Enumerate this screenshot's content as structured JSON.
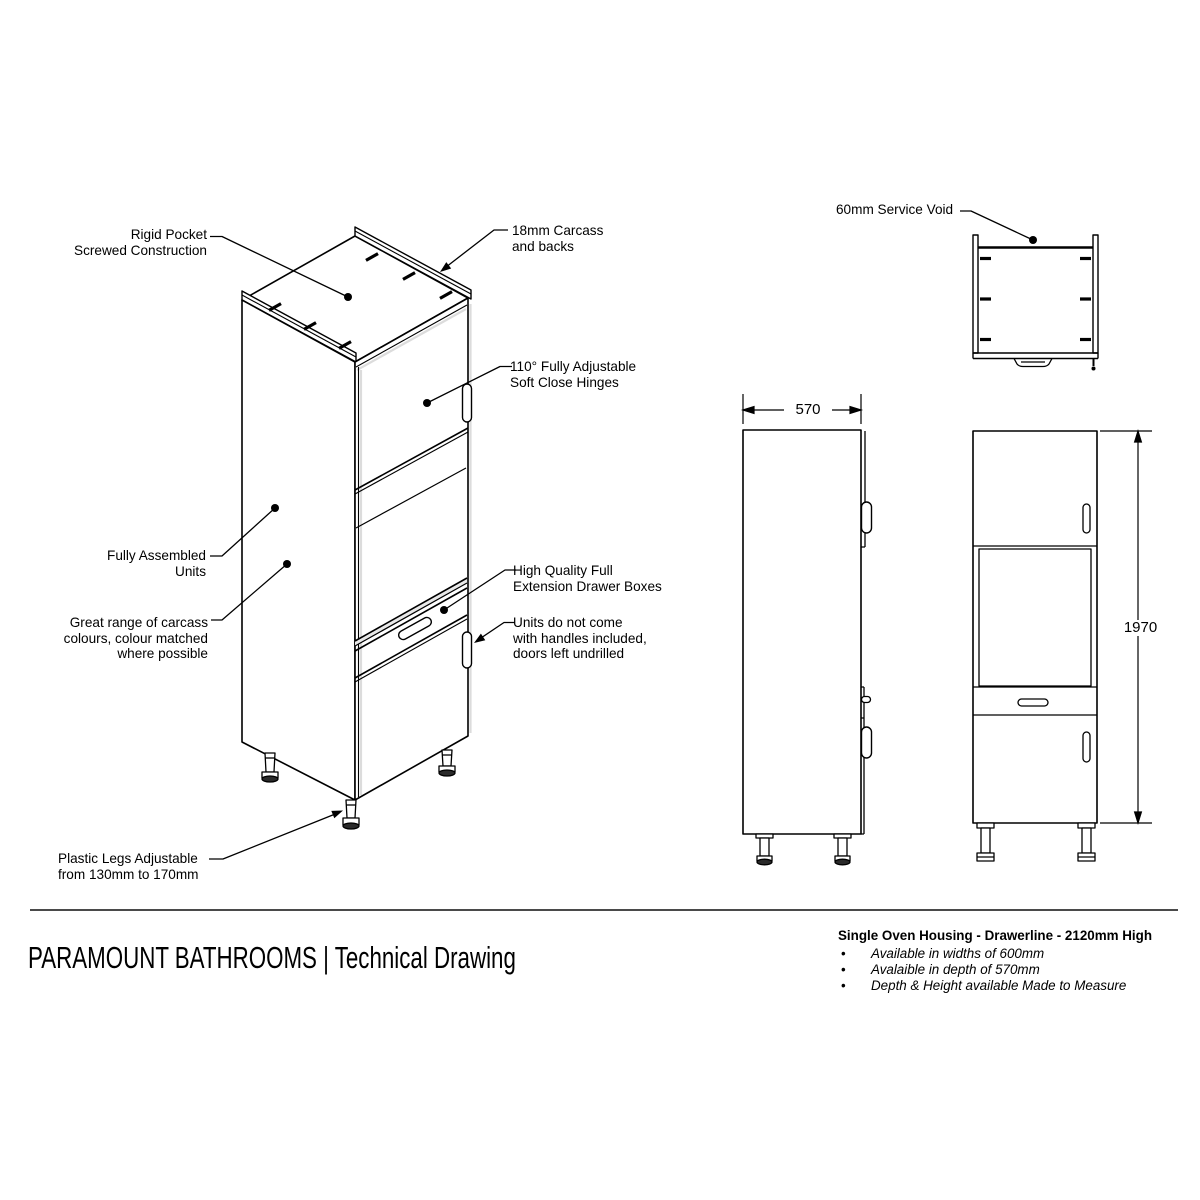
{
  "page": {
    "title": "PARAMOUNT BATHROOMS | Technical Drawing"
  },
  "annotations": {
    "rigid_pocket": "Rigid Pocket\nScrewed Construction",
    "carcass_backs": "18mm Carcass\nand backs",
    "hinges": "110° Fully Adjustable\nSoft Close Hinges",
    "fully_assembled": "Fully Assembled\nUnits",
    "carcass_colours": "Great range of carcass\ncolours, colour matched\nwhere possible",
    "drawer_boxes": "High Quality Full\nExtension Drawer Boxes",
    "no_handles": "Units do not come\nwith handles included,\ndoors left undrilled",
    "plastic_legs": "Plastic Legs Adjustable\nfrom 130mm to 170mm",
    "service_void": "60mm Service Void"
  },
  "dimensions": {
    "depth_mm": "570",
    "height_mm": "1970"
  },
  "product": {
    "heading": "Single Oven Housing - Drawerline - 2120mm High",
    "bullet_char": "•",
    "bullets": [
      "Available in widths of 600mm",
      "Avalaible in depth of 570mm",
      "Depth & Height available Made to Measure"
    ]
  },
  "colors": {
    "line": "#000000",
    "background": "#ffffff",
    "shadow": "#e0e0e0"
  }
}
